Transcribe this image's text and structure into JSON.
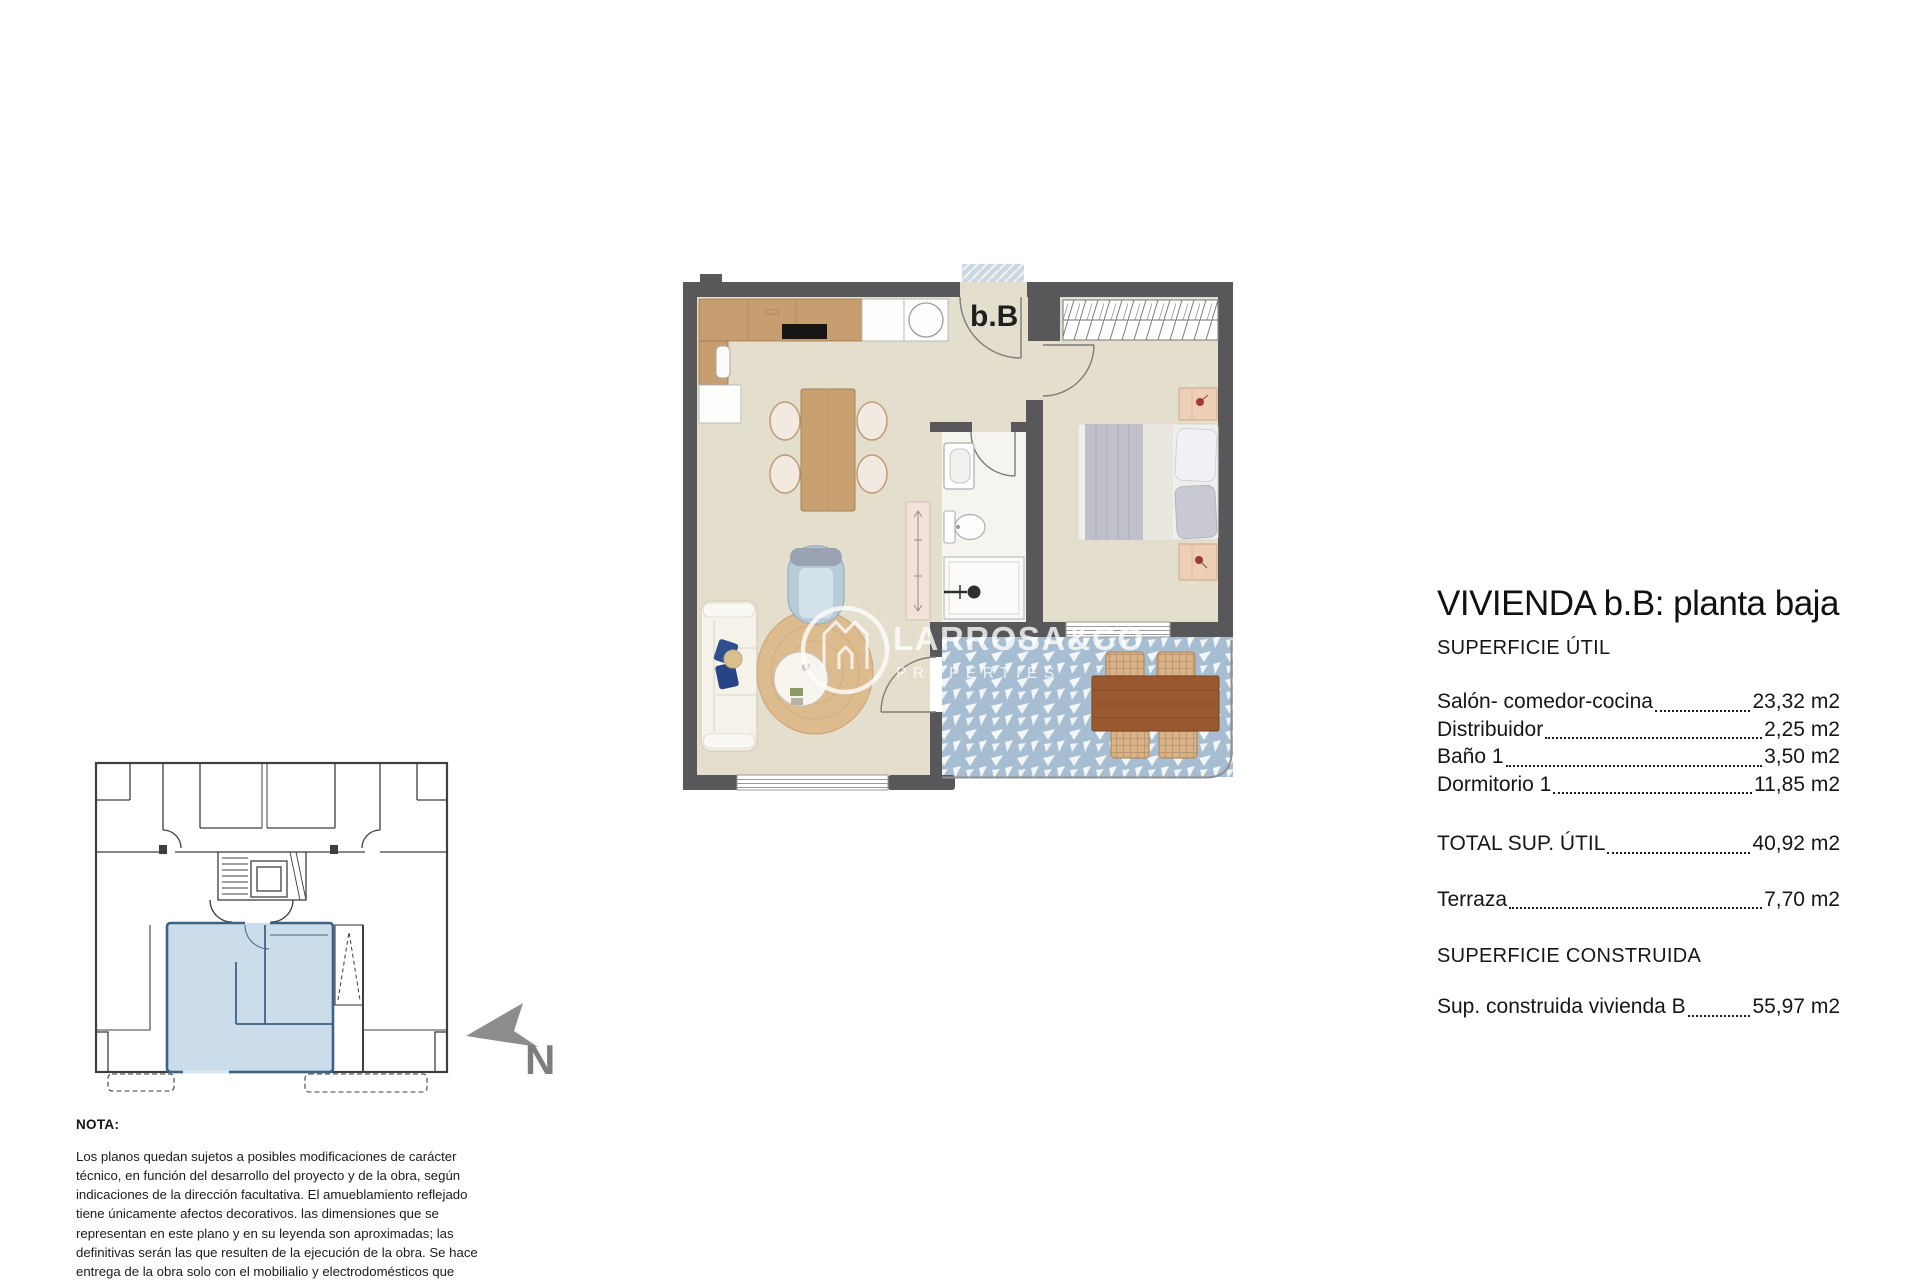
{
  "plan": {
    "unit_label": "b.B"
  },
  "watermark": {
    "brand": "LARROSA&CO",
    "sub": "PROPERTIES"
  },
  "compass": {
    "label": "N"
  },
  "summary": {
    "title": "VIVIENDA b.B: planta baja",
    "section_util": "SUPERFICIE ÚTIL",
    "areas": [
      {
        "label": "Salón- comedor-cocina",
        "value": "23,32 m2"
      },
      {
        "label": "Distribuidor",
        "value": "2,25 m2"
      },
      {
        "label": "Baño 1",
        "value": "3,50 m2"
      },
      {
        "label": "Dormitorio 1",
        "value": "11,85 m2"
      }
    ],
    "total": {
      "label": "TOTAL SUP. ÚTIL",
      "value": "40,92 m2"
    },
    "terrace": {
      "label": "Terraza",
      "value": "7,70 m2"
    },
    "section_built": "SUPERFICIE CONSTRUIDA",
    "built": {
      "label": "Sup. construida vivienda B",
      "value": "55,97 m2"
    }
  },
  "note": {
    "heading": "NOTA:",
    "body": "Los planos quedan sujetos a posibles modificaciones de carácter técnico, en función del desarrollo del proyecto y de la obra, según indicaciones de la dirección facultativa. El amueblamiento reflejado tiene únicamente afectos decorativos. las dimensiones que se representan en este plano y en su leyenda son aproximadas; las definitivas serán las que resulten de la ejecución de la obra. Se hace entrega de la obra solo con el mobilialio y electrodomésticos que consten en la memoria de calidades. El mobiliario de la cocina y la disposición de los sanliarios puede sufrir ligeras variaciones en función del montaje definitivo."
  },
  "colors": {
    "highlight_unit": "#c7d9e8",
    "wall_dark": "#58585a",
    "terrace_tile": "#a7bed2"
  }
}
